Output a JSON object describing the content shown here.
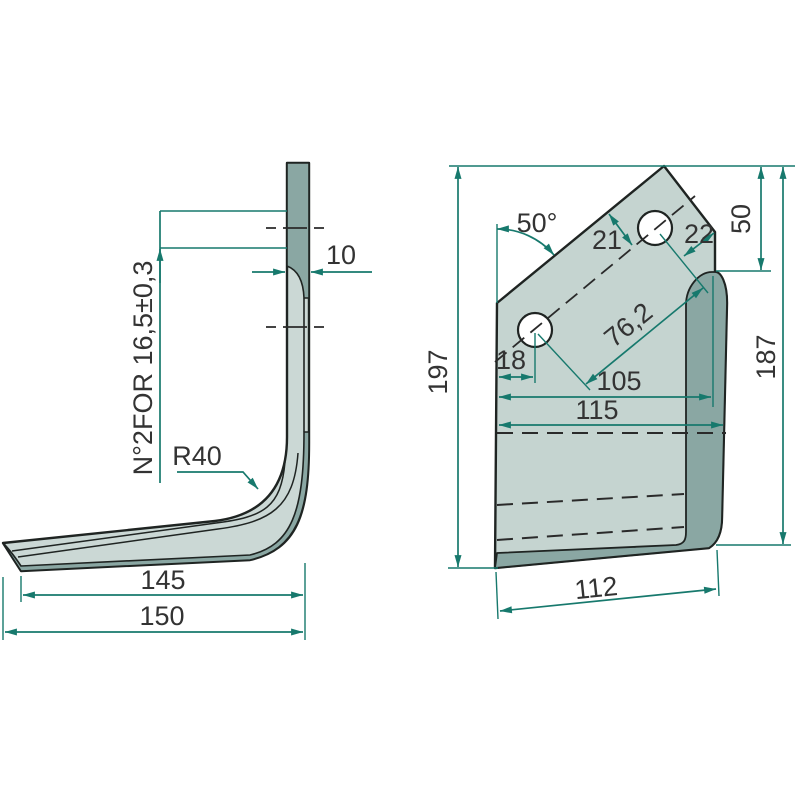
{
  "drawing": {
    "type": "technical-2-view-part-drawing",
    "part": "rotary tiller blade / tine",
    "colors": {
      "background": "#ffffff",
      "outline": "#1f2422",
      "dimension_lines": "#17796d",
      "label_text": "#333333",
      "face_light": "#cbd8d5",
      "face_light_front": "#c5d4d0",
      "face_dark": "#8aa7a3"
    },
    "side_view": {
      "labels": {
        "hole_note": "N°2FOR 16,5±0,3",
        "bend_radius": "R40",
        "thickness": "10",
        "length_inner": "145",
        "length_overall": "150"
      }
    },
    "front_view": {
      "labels": {
        "top_angle": "50°",
        "edge_to_holeline": "21",
        "hole_to_corner": "22",
        "top_width": "50",
        "height_overall": "197",
        "height_right": "187",
        "hole_edge_margin": "18",
        "hole_pitch": "76,2",
        "width_to_corner": "105",
        "width_face": "115",
        "width_bottom": "112"
      },
      "holes": {
        "count": 2,
        "diameter_note": "16,5±0,3"
      }
    }
  }
}
